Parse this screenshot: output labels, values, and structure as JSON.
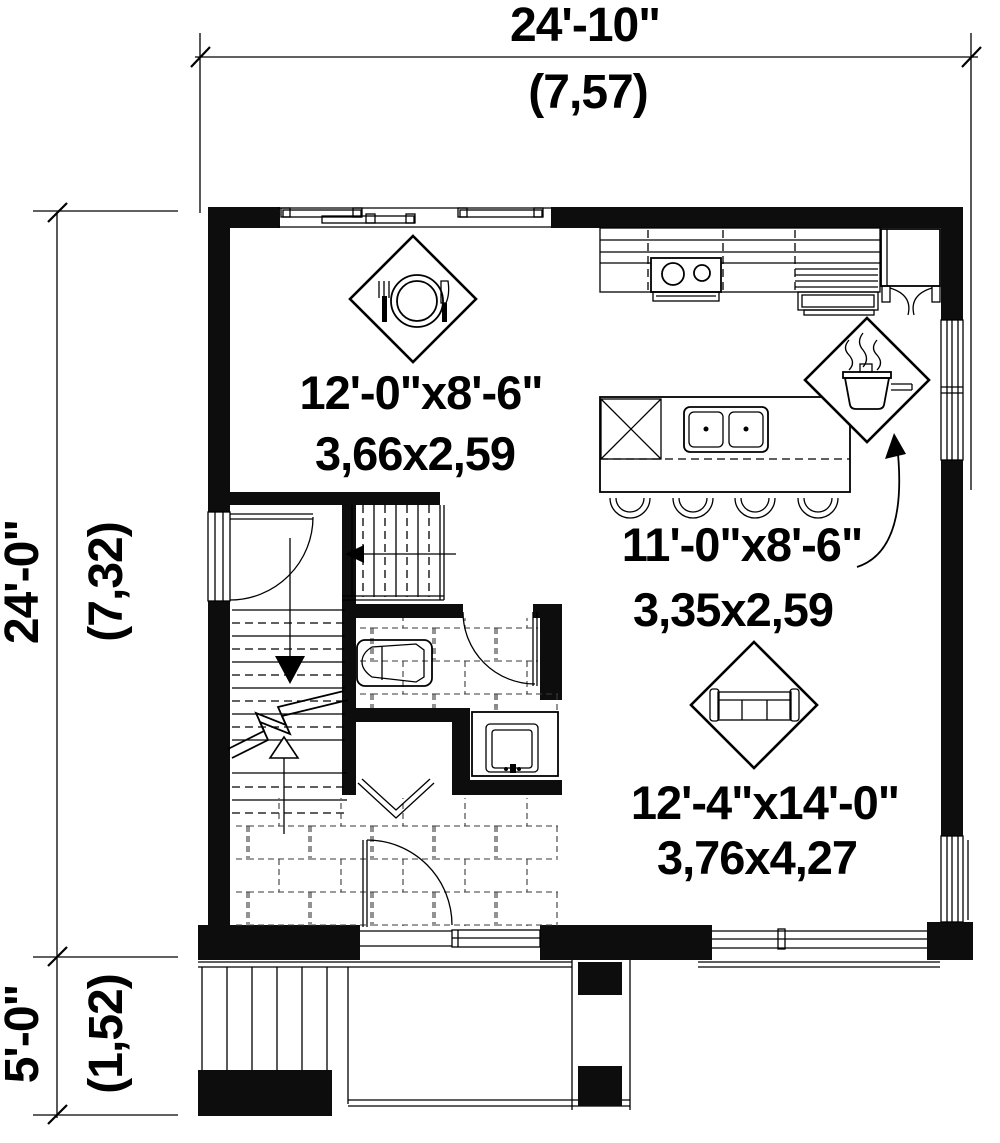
{
  "plan": {
    "overall_width": {
      "imperial": "24'-10\"",
      "metric": "(7,57)"
    },
    "overall_depth": {
      "imperial": "24'-0\"",
      "metric": "(7,32)"
    },
    "porch_depth": {
      "imperial": "5'-0\"",
      "metric": "(1,52)"
    }
  },
  "rooms": {
    "dining": {
      "imperial": "12'-0\"x8'-6\"",
      "metric": "3,66x2,59",
      "icon": "place-setting-icon"
    },
    "kitchen": {
      "imperial": "11'-0\"x8'-6\"",
      "metric": "3,35x2,59",
      "icon": "cooking-pot-icon"
    },
    "living": {
      "imperial": "12'-4\"x14'-0\"",
      "metric": "3,76x4,27",
      "icon": "sofa-icon"
    }
  },
  "colors": {
    "ink": "#000000",
    "paper": "#ffffff"
  }
}
